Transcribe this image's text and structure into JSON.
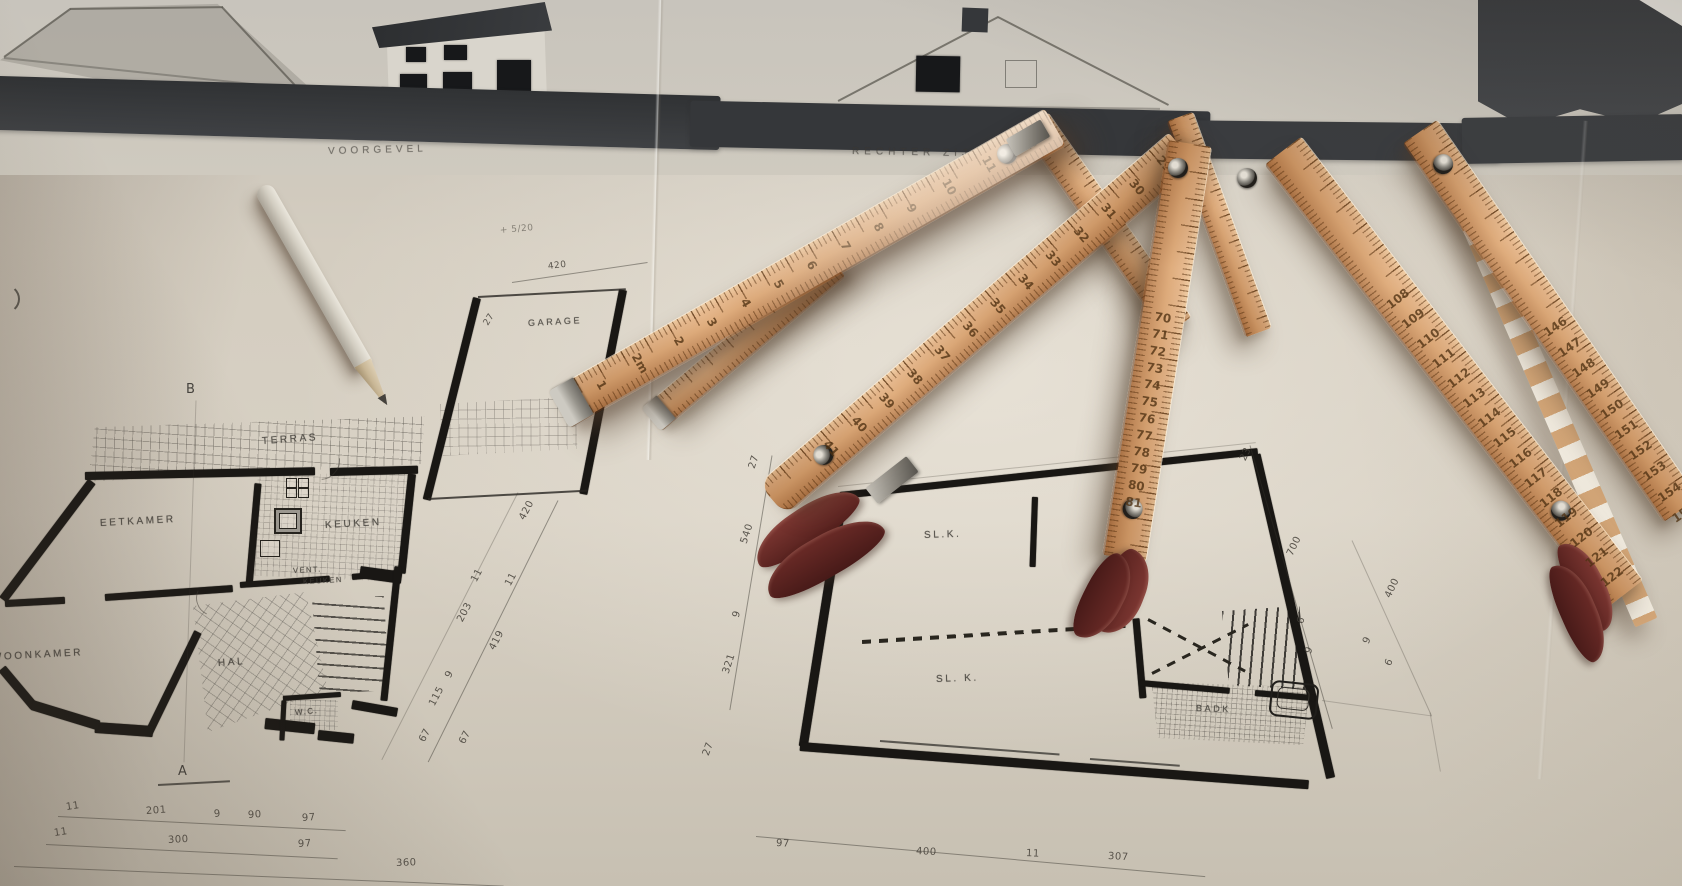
{
  "photo_alt": "Architectural floor-plan drawings with folding wooden rulers and a pencil",
  "elevation": {
    "left_label": "VOORGEVEL",
    "right_label": "RECHTER ZIJGEVEL"
  },
  "note": "+ 5/20",
  "plan_left": {
    "rooms": {
      "terras": "TERRAS",
      "eetkamer": "EETKAMER",
      "keuken": "KEUKEN",
      "woonkamer": "WOONKAMER",
      "hal": "HAL",
      "wc": "W.C.",
      "vent": "VENT.",
      "vent2": "KEUKEN"
    },
    "markers": {
      "top": "B",
      "bottom": "A"
    },
    "dims_right_strip": [
      "420",
      "11",
      "11",
      "203",
      "419",
      "9",
      "115",
      "67",
      "67"
    ],
    "dims_bottom_row1": [
      "11",
      "201",
      "9",
      "90",
      "97"
    ],
    "dims_bottom_row2": [
      "11",
      "300",
      "97"
    ],
    "dims_bottom_total": "360"
  },
  "garage": {
    "label": "GARAGE",
    "dim_top": "420",
    "dim_left": "27"
  },
  "plan_right": {
    "rooms": {
      "slk_top": "SL.K.",
      "slk_bottom": "SL. K.",
      "badk": "BADK"
    },
    "dims_left_strip": [
      "27",
      "540",
      "9",
      "321"
    ],
    "dims_right_strip": [
      "23",
      "700",
      "6",
      "9"
    ],
    "dims_right_outer": [
      "400",
      "9",
      "6"
    ],
    "dims_bottom": [
      "97",
      "400",
      "11",
      "307"
    ],
    "dim_corner": "27"
  },
  "rulers": {
    "r1_numbers": [
      "1",
      "2m",
      "2",
      "3",
      "4",
      "5",
      "6",
      "7",
      "8",
      "9",
      "10",
      "11",
      "12"
    ],
    "r2_numbers": [
      "41",
      "40",
      "39",
      "38",
      "37",
      "36",
      "35",
      "34",
      "33",
      "32",
      "31",
      "30",
      "29"
    ],
    "r3_numbers": [
      "70",
      "71",
      "72",
      "73",
      "74",
      "75",
      "76",
      "77",
      "78",
      "79",
      "80",
      "81"
    ],
    "r4_numbers": [
      "108",
      "109",
      "110",
      "111",
      "112",
      "113",
      "114",
      "115",
      "116",
      "117",
      "118",
      "119",
      "120",
      "121",
      "122"
    ],
    "r5_numbers": [
      "146",
      "147",
      "148",
      "149",
      "150",
      "151",
      "152",
      "153",
      "154",
      "155"
    ]
  },
  "colors": {
    "paper": "#d5cec2",
    "ink": "#191714",
    "ground_band": "#393b3d",
    "ruler_wood": "#dfae7f",
    "ruler_shadow_wood": "#aa7042",
    "hinge_burgundy": "#6e2b27",
    "metal": "#9b978e",
    "pencil_body": "#d8d3c9"
  }
}
